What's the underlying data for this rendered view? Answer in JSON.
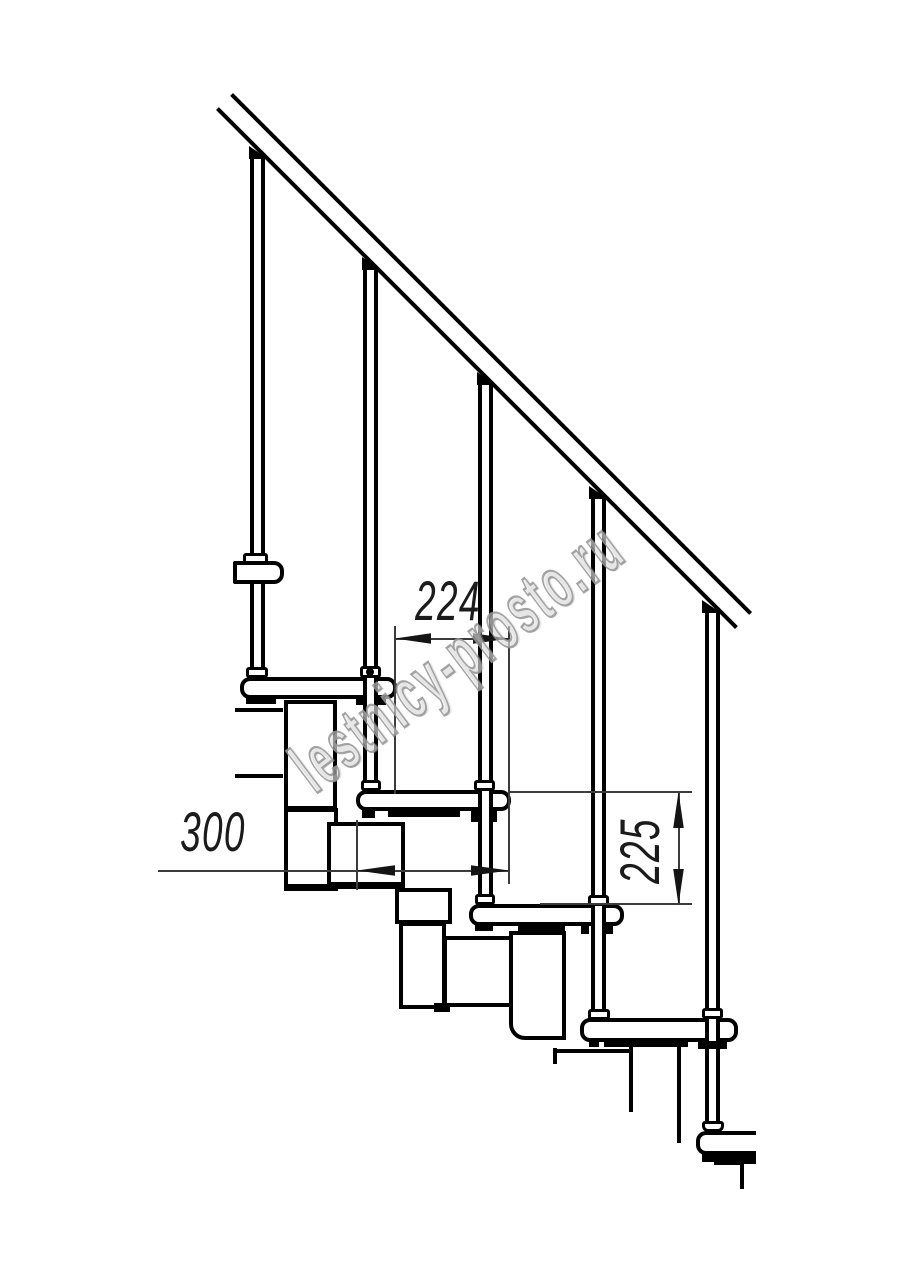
{
  "page": {
    "background": "#ffffff",
    "kind": "technical-drawing",
    "subject": "modular staircase side elevation fragment"
  },
  "watermark": {
    "text": "lestnicy-prosto.ru",
    "color": "#949494"
  },
  "dimensions": {
    "step_run": {
      "value": "224",
      "orientation": "horizontal"
    },
    "tread_depth": {
      "value": "300",
      "orientation": "horizontal"
    },
    "step_rise": {
      "value": "225",
      "orientation": "vertical"
    }
  },
  "colors": {
    "line": "#000000",
    "dim_line": "#3c3c3c",
    "dim_text": "#1b1b1b"
  }
}
